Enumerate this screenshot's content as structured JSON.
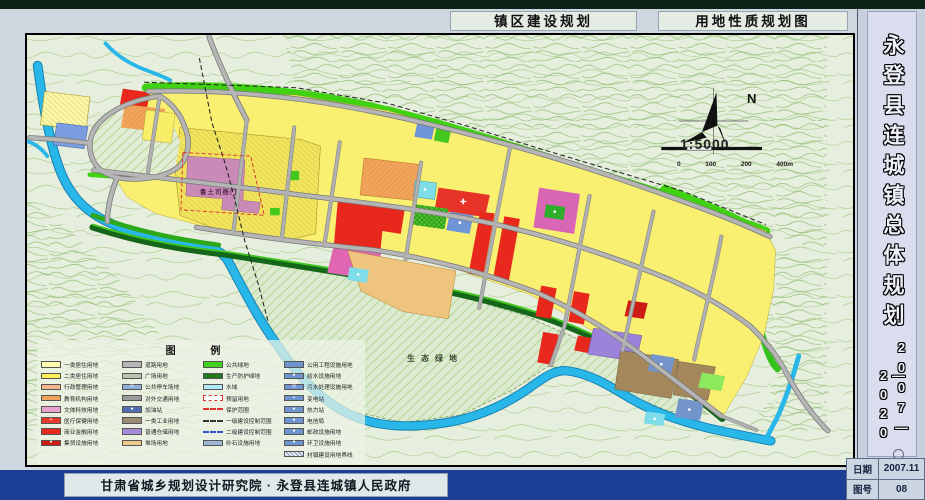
{
  "header": {
    "title_left": "镇区建设规划",
    "title_right": "用地性质规划图"
  },
  "sidebar": {
    "title": "永登县连城镇总体规划",
    "years_col1": "2007—",
    "years_col2": "—2020",
    "date_label": "日期",
    "date_value": "2007.11",
    "sheet_label": "图号",
    "sheet_value": "08"
  },
  "footer": {
    "credit": "甘肃省城乡规划设计研究院 · 永登县连城镇人民政府"
  },
  "map": {
    "labels": {
      "historic_site": "鲁土司衙门",
      "eco_green": "生态绿地",
      "north": "N",
      "scale": "1:5000",
      "scale_ticks": [
        "0",
        "100",
        "200",
        "400m"
      ]
    },
    "legend": {
      "title": "图 例",
      "columns": [
        {
          "items": [
            {
              "label": "一类居住用地",
              "bg": "#fdf9b0"
            },
            {
              "label": "二类居住用地",
              "bg": "#fbf157"
            },
            {
              "label": "行政管理用地",
              "bg": "#f4b78e"
            },
            {
              "label": "教育机构用地",
              "bg": "#f2a35a"
            },
            {
              "label": "文体科技用地",
              "bg": "#eaa3cd"
            },
            {
              "label": "医疗保健用地",
              "bg": "#e7392b",
              "glyph": "+"
            },
            {
              "label": "商业金融用地",
              "bg": "#ea2a1e"
            },
            {
              "label": "集贸设施用地",
              "bg": "#cf1b13",
              "glyph": "●"
            }
          ]
        },
        {
          "items": [
            {
              "label": "道路用地",
              "bg": "#b5b5b5"
            },
            {
              "label": "广场用地",
              "bg": "#b9c4ae"
            },
            {
              "label": "公共停车场地",
              "bg": "#8fb1d8",
              "glyph": "P"
            },
            {
              "label": "对外交通用地",
              "bg": "#9b9b9b"
            },
            {
              "label": "加油站",
              "bg": "#4f6fae",
              "glyph": "●"
            },
            {
              "label": "一类工业用地",
              "bg": "#9b8a74"
            },
            {
              "label": "普通仓储用地",
              "bg": "#a68bd9"
            },
            {
              "label": "堆场用地",
              "bg": "#edc98d"
            }
          ]
        },
        {
          "items": [
            {
              "label": "公共绿地",
              "bg": "#3fd41c"
            },
            {
              "label": "生产防护绿地",
              "bg": "#1d7a1f"
            },
            {
              "label": "水域",
              "bg": "#aee7f6"
            },
            {
              "label": "预留用地",
              "bg": "#ffffff",
              "border": "1px dashed #e03030"
            },
            {
              "label": "保护范围",
              "line": "2px dashed #e03030"
            },
            {
              "label": "一级建设控制范围",
              "line": "2px dashed #333333"
            },
            {
              "label": "二级建设控制范围",
              "line": "2px dashed #3355cc"
            },
            {
              "label": "砂石设施用地",
              "bg": "#9db6d6",
              "glyph": "··"
            }
          ]
        },
        {
          "items": [
            {
              "label": "公用工程设施用地",
              "bg": "#6f95d0"
            },
            {
              "label": "给水设施用地",
              "bg": "#6f95d0",
              "glyph": "●"
            },
            {
              "label": "污水处理设施用地",
              "bg": "#6f95d0",
              "glyph": "◎"
            },
            {
              "label": "变电站",
              "bg": "#6f95d0",
              "glyph": "+"
            },
            {
              "label": "热力站",
              "bg": "#6f95d0",
              "glyph": "●"
            },
            {
              "label": "电信局",
              "bg": "#6f95d0",
              "glyph": "●"
            },
            {
              "label": "邮政设施用地",
              "bg": "#6f95d0",
              "glyph": "●"
            },
            {
              "label": "环卫设施用地",
              "bg": "#6f95d0",
              "glyph": "●"
            },
            {
              "label": "村镇建设用地界线",
              "hatch": true
            }
          ]
        }
      ]
    },
    "colors": {
      "footer_bar": "#1d3e95",
      "title_box_bg": "#e4ece4",
      "sidebar_bg": "#d9dded",
      "map_base": "#e6eedd",
      "river": "#29b6e8",
      "road": "#b5b5b5",
      "residential_yellow": "#f9ef70",
      "commercial_red": "#ea2a1e",
      "public_green": "#3fd41c",
      "protective_green": "#14661a",
      "historic_mauve": "#c98ab8"
    }
  }
}
